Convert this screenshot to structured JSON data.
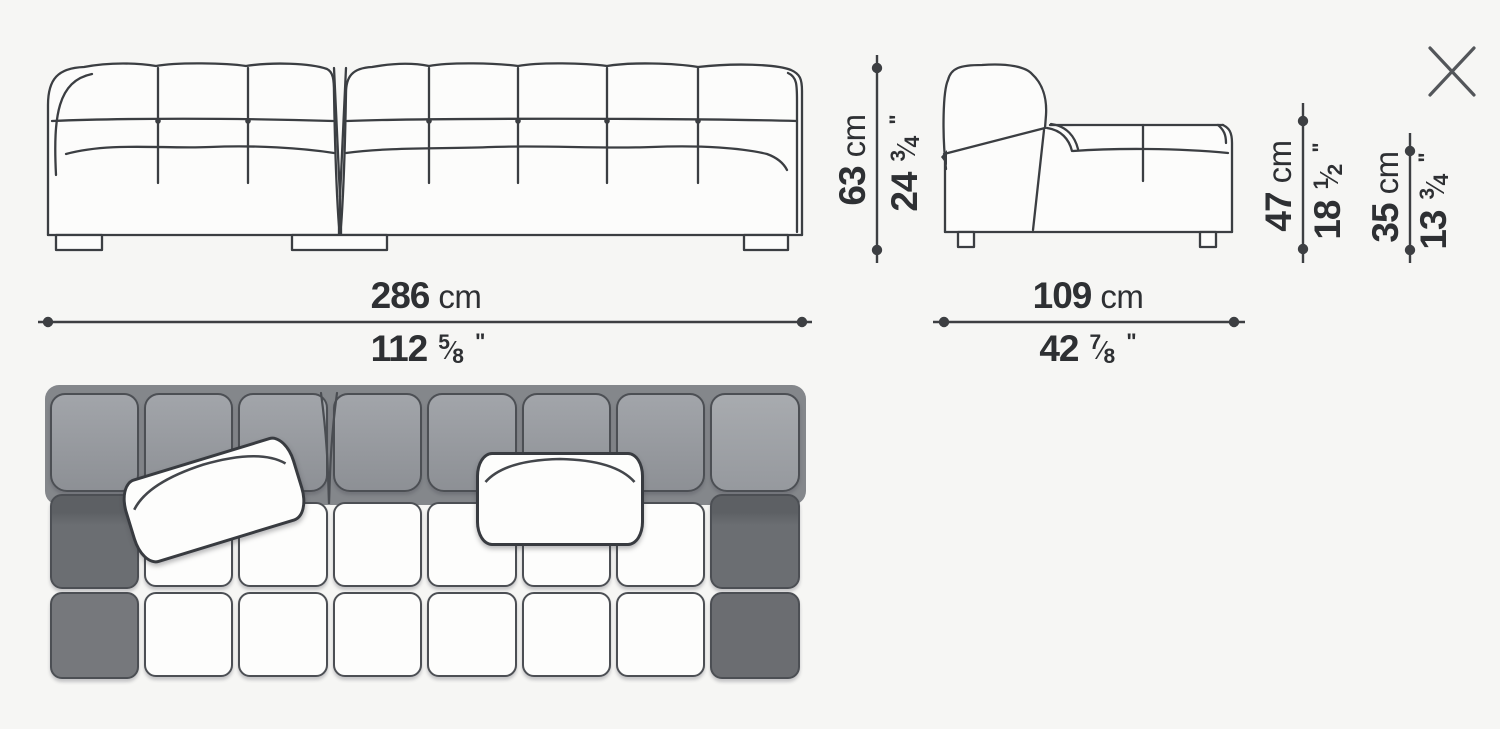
{
  "colors": {
    "background": "#f6f6f4",
    "line_art": "#3b3e42",
    "dim_line": "#3d3f42",
    "text": "#2e3033",
    "close_icon": "#53565a"
  },
  "close": {
    "icon": "x-close"
  },
  "dims": {
    "width_cm": {
      "value": "286",
      "unit": "cm"
    },
    "width_in": {
      "whole": "112",
      "num": "5",
      "den": "8",
      "slash": "⁄",
      "mark": "\""
    },
    "depth_cm": {
      "value": "109",
      "unit": "cm"
    },
    "depth_in": {
      "whole": "42",
      "num": "7",
      "den": "8",
      "slash": "⁄",
      "mark": "\""
    },
    "height_cm": {
      "value": "63",
      "unit": "cm"
    },
    "height_in": {
      "whole": "24",
      "num": "3",
      "den": "4",
      "slash": "⁄",
      "mark": "\""
    },
    "back_height_cm": {
      "value": "47",
      "unit": "cm"
    },
    "back_height_in": {
      "whole": "18",
      "num": "1",
      "den": "2",
      "slash": "⁄",
      "mark": "\""
    },
    "seat_height_cm": {
      "value": "35",
      "unit": "cm"
    },
    "seat_height_in": {
      "whole": "13",
      "num": "3",
      "den": "4",
      "slash": "⁄",
      "mark": "\""
    }
  },
  "plan": {
    "columns": 8,
    "module_split_after_column": 3,
    "back_grad_top": "#a2a5aa",
    "back_grad_bottom": "#8d9095",
    "back_right_top": "#a8abaf",
    "back_right_bottom": "#96999e",
    "side_sliver": "#5d6064",
    "side_mid": "#6b6e72",
    "side_front_left": "#76787c",
    "side_front_right": "#6b6d71",
    "seat_white": "#fdfdfc",
    "outline": "#4c4f54"
  }
}
